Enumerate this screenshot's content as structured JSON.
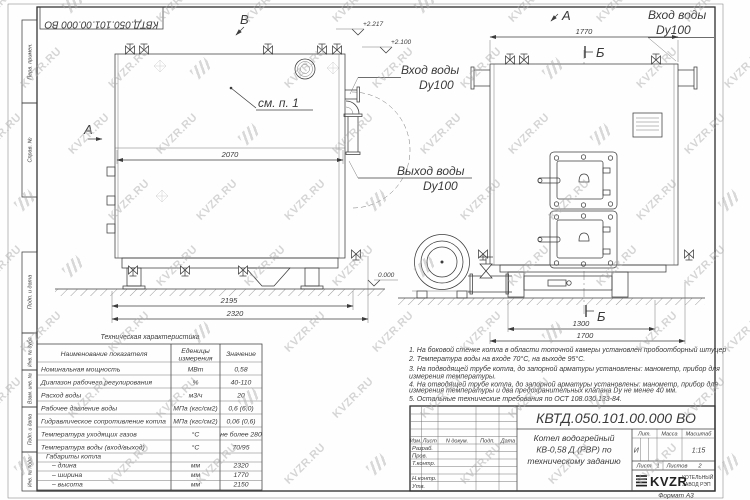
{
  "watermark": {
    "text": "KVZR.RU"
  },
  "sheet": {
    "top_stamp": "КВТД.050.101.00.000  ВО",
    "format_label": "Формат   А3",
    "margin": {
      "perv": "Перв. примен.",
      "sprav": "Справ. №",
      "podp1": "Подп. и дата",
      "inv_dubl": "Инв. № дубл.",
      "vzam": "Взам. инв. №",
      "podp2": "Подп. и дата",
      "inv_podl": "Инв. № подл."
    }
  },
  "drawing": {
    "labels": {
      "view_b": "В",
      "view_a_left": "А",
      "view_a_top": "А",
      "section_b_top": "Б",
      "section_b_bottom": "Б",
      "see_item": "см. п. 1",
      "elev_2217": "+2.217",
      "elev_2100": "+2.100",
      "elev_0": "0.000"
    },
    "dims": {
      "d2070": "2070",
      "d2195": "2195",
      "d2320": "2320",
      "d1770": "1770",
      "d1300": "1300",
      "d1700": "1700"
    },
    "callouts": {
      "inlet_right": {
        "l1": "Вход воды",
        "l2": "Dy100"
      },
      "inlet_left": {
        "l1": "Вход воды",
        "l2": "Dy100"
      },
      "outlet": {
        "l1": "Выход воды",
        "l2": "Dy100"
      }
    }
  },
  "spec_table": {
    "title": "Техническая характеристика",
    "col1": "Наименование показателя",
    "col2a": "Еденицы",
    "col2b": "измерения",
    "col3": "Значение",
    "rows": [
      {
        "name": "Номинальная мощность",
        "unit": "МВт",
        "value": "0,58"
      },
      {
        "name": "Диапазон рабочего регулирования",
        "unit": "%",
        "value": "40-110"
      },
      {
        "name": "Расход воды",
        "unit": "м3/ч",
        "value": "20"
      },
      {
        "name": "Рабочее давление воды",
        "unit": "МПа (кгс/см2)",
        "value": "0,6 (6,0)"
      },
      {
        "name": "Гидравлическое сопротивление котла",
        "unit": "МПа (кгс/см2)",
        "value": "0,06 (0,6)"
      },
      {
        "name": "Температура уходящих газов",
        "unit": "°С",
        "value": "не более 280"
      },
      {
        "name": "Температура воды (вход/выход)",
        "unit": "°С",
        "value": "70/95"
      },
      {
        "name": "Габариты котла",
        "unit": "",
        "value": ""
      },
      {
        "name": "– длина",
        "unit": "мм",
        "value": "2320"
      },
      {
        "name": "– ширина",
        "unit": "мм",
        "value": "1770"
      },
      {
        "name": "– высота",
        "unit": "мм",
        "value": "2150"
      }
    ]
  },
  "notes": {
    "lines": [
      "1.  На боковой стенке котла в области топочной камеры установлен пробоотборный штуцер",
      "2.  Температура воды на входе 70°С, на выходе 95°С.",
      "3.  На подводящей трубе котла, до запорной арматуры установлены: манометр, прибор для",
      "измерения температуры.",
      "4.  На отводящей трубе котла, до запорной арматуры установлены: манометр, прибор для",
      "измерения температуры и два предохранительных клапана  Dу не менее  40 мм.",
      "5.  Остальные технические требования по ОСТ  108.030.133-84."
    ]
  },
  "title_block": {
    "doc_number": "КВТД.050.101.00.000  ВО",
    "title_l1": "Котел водогрейный",
    "title_l2": "КВ-0,58 Д (РВР) по",
    "title_l3": "техническому заданию",
    "lit_label": "Лит.",
    "mass_label": "Масса",
    "scale_label": "Масштаб",
    "lit_value": "И",
    "scale_value": "1:15",
    "sheet_label": "Лист",
    "sheet_value": "1",
    "sheets_label": "Листов",
    "sheets_value": "2",
    "col_izm": "Изм.",
    "col_list": "Лист",
    "col_ndoc": "N докум.",
    "col_podp": "Подп.",
    "col_data": "Дата",
    "row_razrab": "Разраб.",
    "row_prov": "Пров.",
    "row_tkontr": "Т.контр.",
    "row_nkontr": "Н.контр.",
    "row_utv": "Утв.",
    "org_name": "KVZR",
    "org_sub1": "КОТЕЛЬНЫЙ",
    "org_sub2": "ЗАВОД РЭП"
  }
}
